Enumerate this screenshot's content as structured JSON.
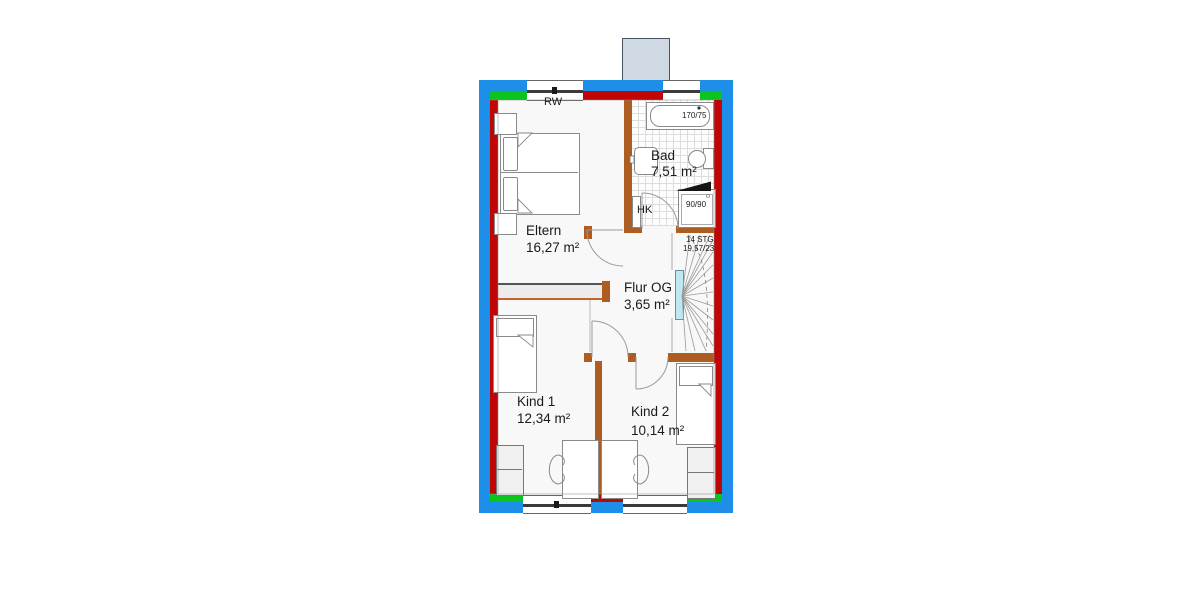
{
  "plan": {
    "title": "Obergeschoss Grundriss",
    "rooms": [
      {
        "id": "eltern",
        "name": "Eltern",
        "area": "16,27 m²"
      },
      {
        "id": "bad",
        "name": "Bad",
        "area": "7,51 m²"
      },
      {
        "id": "flur",
        "name": "Flur OG",
        "area": "3,65 m²"
      },
      {
        "id": "kind1",
        "name": "Kind 1",
        "area": "12,34 m²"
      },
      {
        "id": "kind2",
        "name": "Kind 2",
        "area": "10,14 m²"
      }
    ],
    "annotations": {
      "smoke_detector": "RW",
      "radiator": "HK",
      "stairs_line1": "14 STG.",
      "stairs_line2": "19,57/23",
      "bathtub_size": "170/75",
      "shower_size": "90/90"
    },
    "legend_colors": {
      "exterior_band": "#1e8fe8",
      "masonry": "#c00505",
      "green_segments": "#0cc41e",
      "interior_walls": "#ad5c22",
      "stair_rail": "#bfe8f2"
    }
  }
}
